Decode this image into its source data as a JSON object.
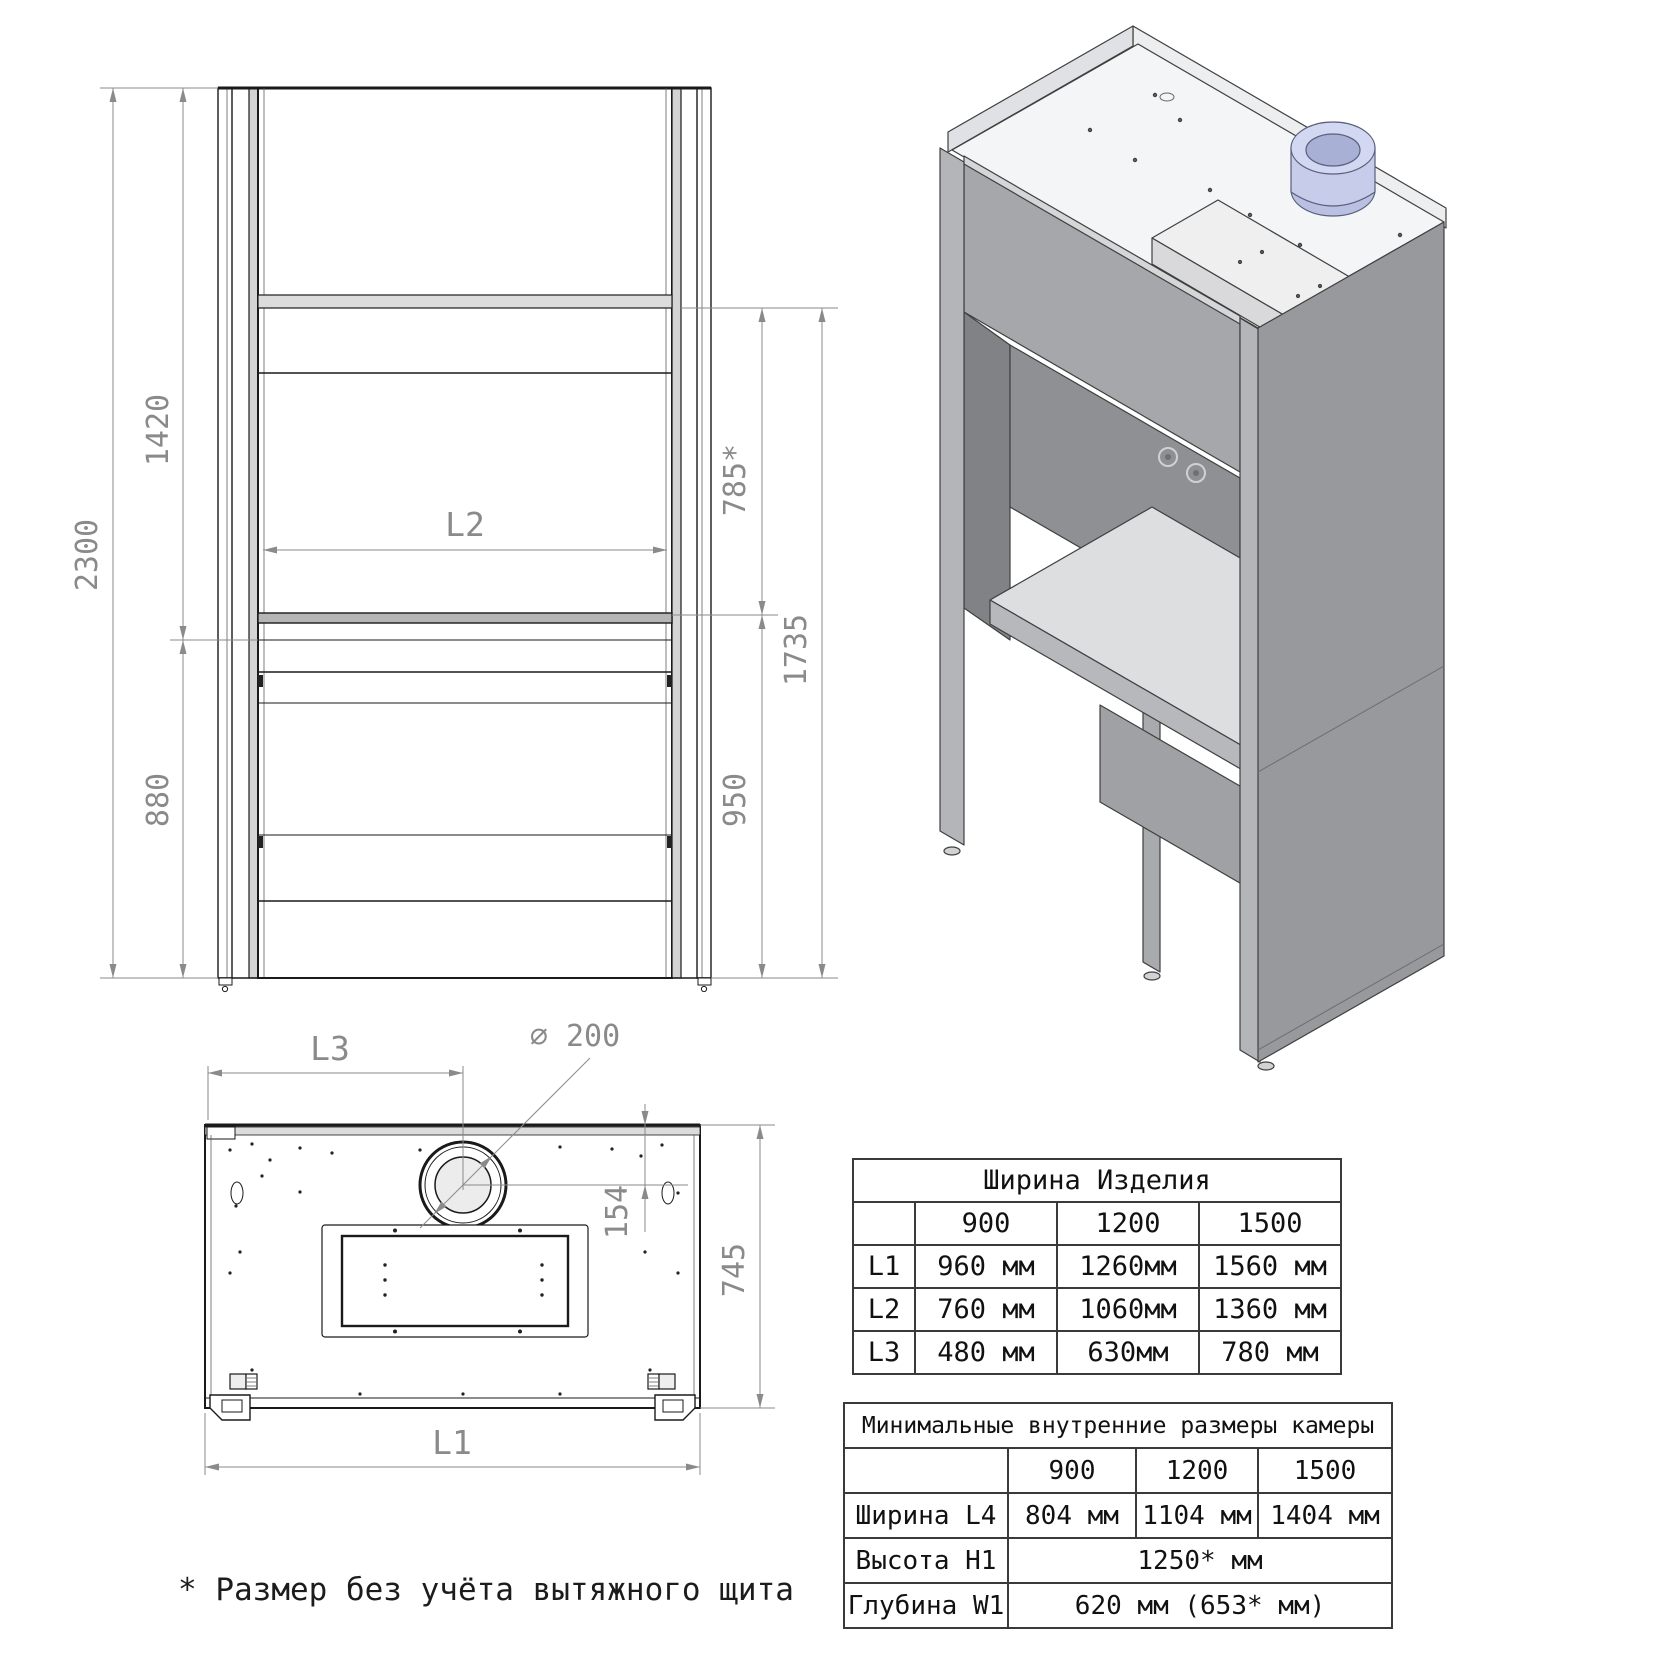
{
  "drawing": {
    "front_view": {
      "dim_2300": "2300",
      "dim_1420": "1420",
      "dim_880": "880",
      "dim_l2": "L2",
      "dim_785": "785*",
      "dim_1735": "1735",
      "dim_950": "950"
    },
    "top_view": {
      "dim_l3": "L3",
      "dim_diameter": "∅ 200",
      "dim_154": "154",
      "dim_745": "745",
      "dim_l1": "L1"
    },
    "footnote": "* Размер без учёта вытяжного щита"
  },
  "width_table": {
    "title": "Ширина Изделия",
    "col_headers": [
      "900",
      "1200",
      "1500"
    ],
    "rows": [
      {
        "label": "L1",
        "values": [
          "960 мм",
          "1260мм",
          "1560 мм"
        ]
      },
      {
        "label": "L2",
        "values": [
          "760 мм",
          "1060мм",
          "1360 мм"
        ]
      },
      {
        "label": "L3",
        "values": [
          "480 мм",
          "630мм",
          "780 мм"
        ]
      }
    ]
  },
  "inner_table": {
    "title": "Минимальные внутренние размеры камеры",
    "col_headers": [
      "900",
      "1200",
      "1500"
    ],
    "rows": [
      {
        "label": "Ширина L4",
        "values": [
          "804 мм",
          "1104 мм",
          "1404 мм"
        ]
      },
      {
        "label": "Высота H1",
        "merged_value": "1250* мм"
      },
      {
        "label": "Глубина W1",
        "merged_value": "620 мм (653* мм)"
      }
    ]
  },
  "colors": {
    "duct_fill": "#c6cce9",
    "side_panel_gray": "#97999c",
    "dimension_gray": "#8a8a8a"
  }
}
